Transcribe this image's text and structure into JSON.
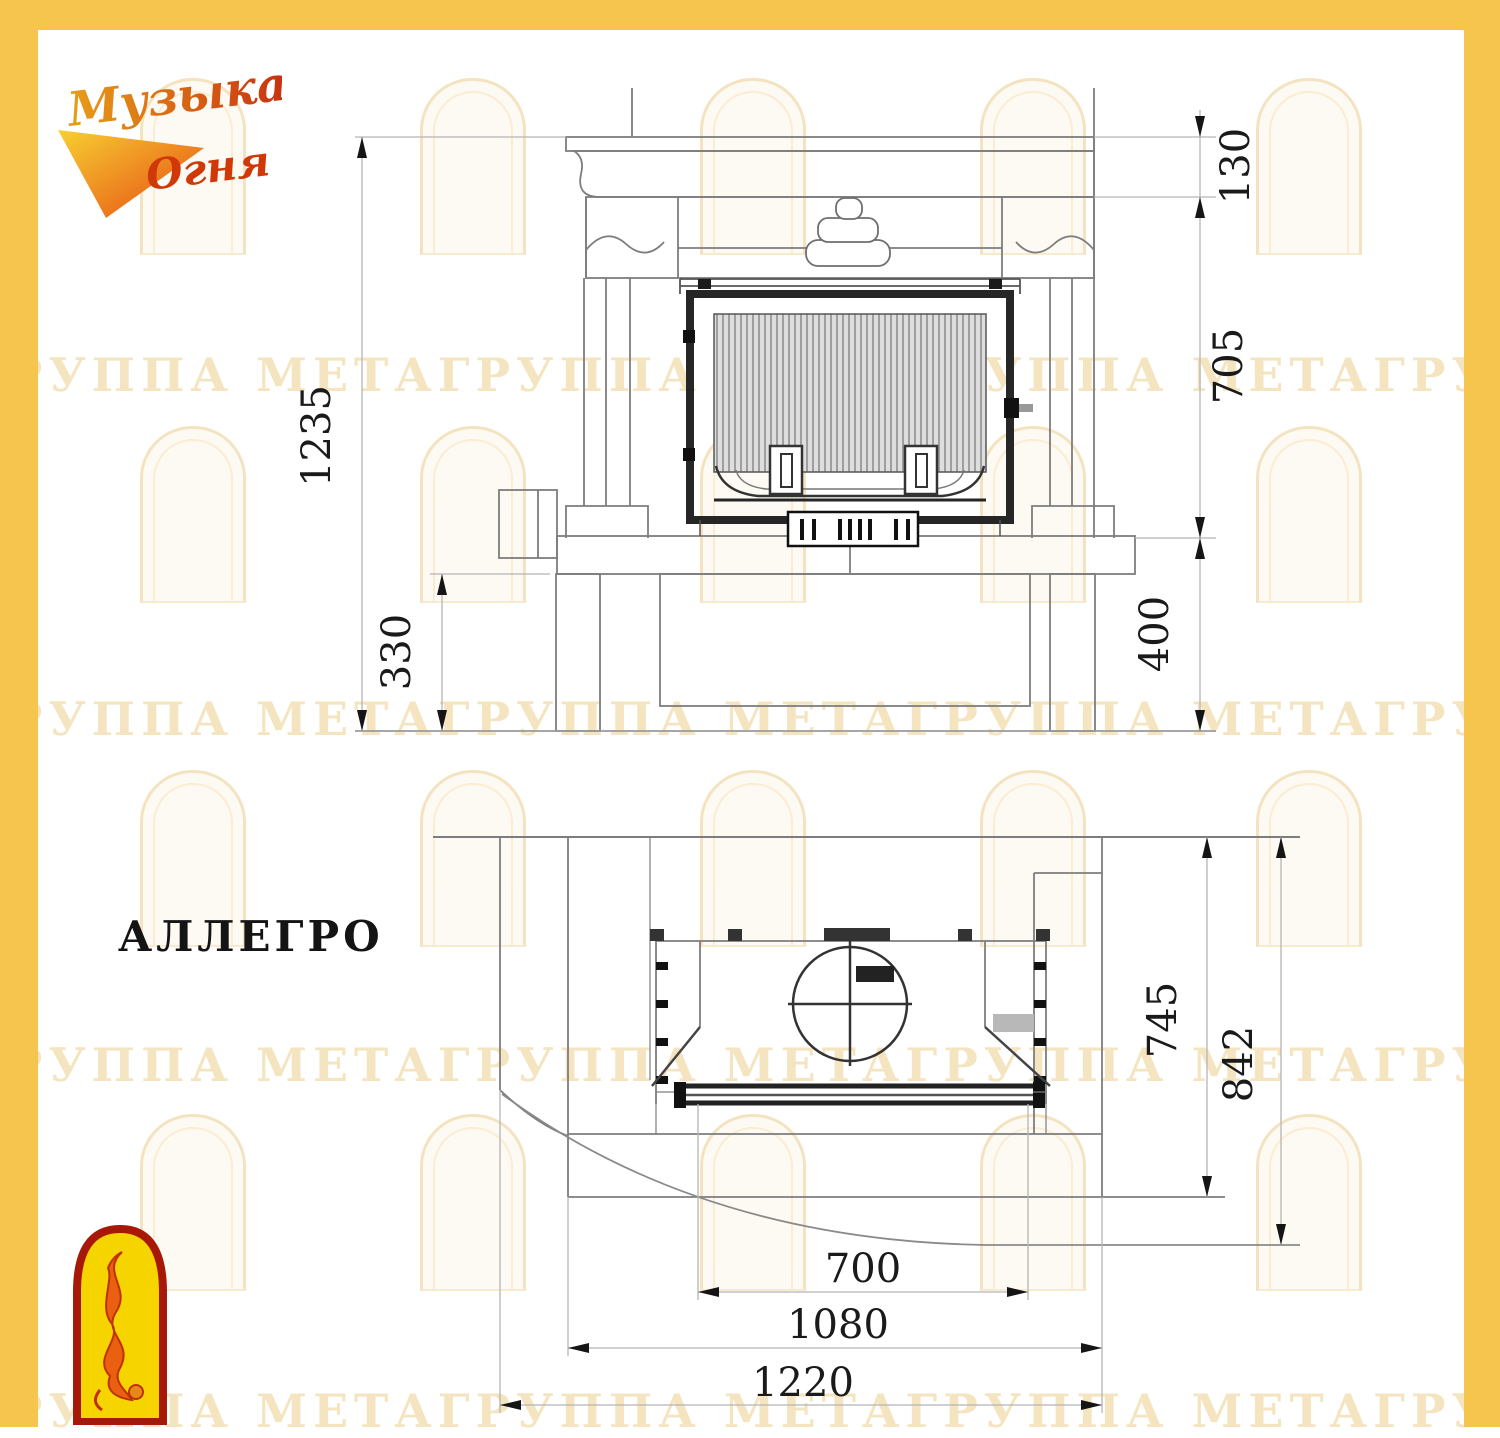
{
  "page": {
    "border_color": "#f6c54d",
    "background": "#ffffff"
  },
  "logo": {
    "line1": "Музыка",
    "line2": "Огня"
  },
  "model": {
    "name": "АЛЛЕГРО"
  },
  "watermark": {
    "text": "ГРУППА МЕТАГРУППА МЕТАГРУППА МЕТАГРУППА МЕТА"
  },
  "front_view": {
    "dims": {
      "total_height": "1235",
      "plinth_height": "330",
      "mantel_height": "130",
      "opening_height": "705",
      "base_height": "400"
    }
  },
  "plan_view": {
    "dims": {
      "hearth_depth": "745",
      "total_depth": "842",
      "firebox_width": "700",
      "body_width": "1080",
      "total_width": "1220"
    }
  }
}
